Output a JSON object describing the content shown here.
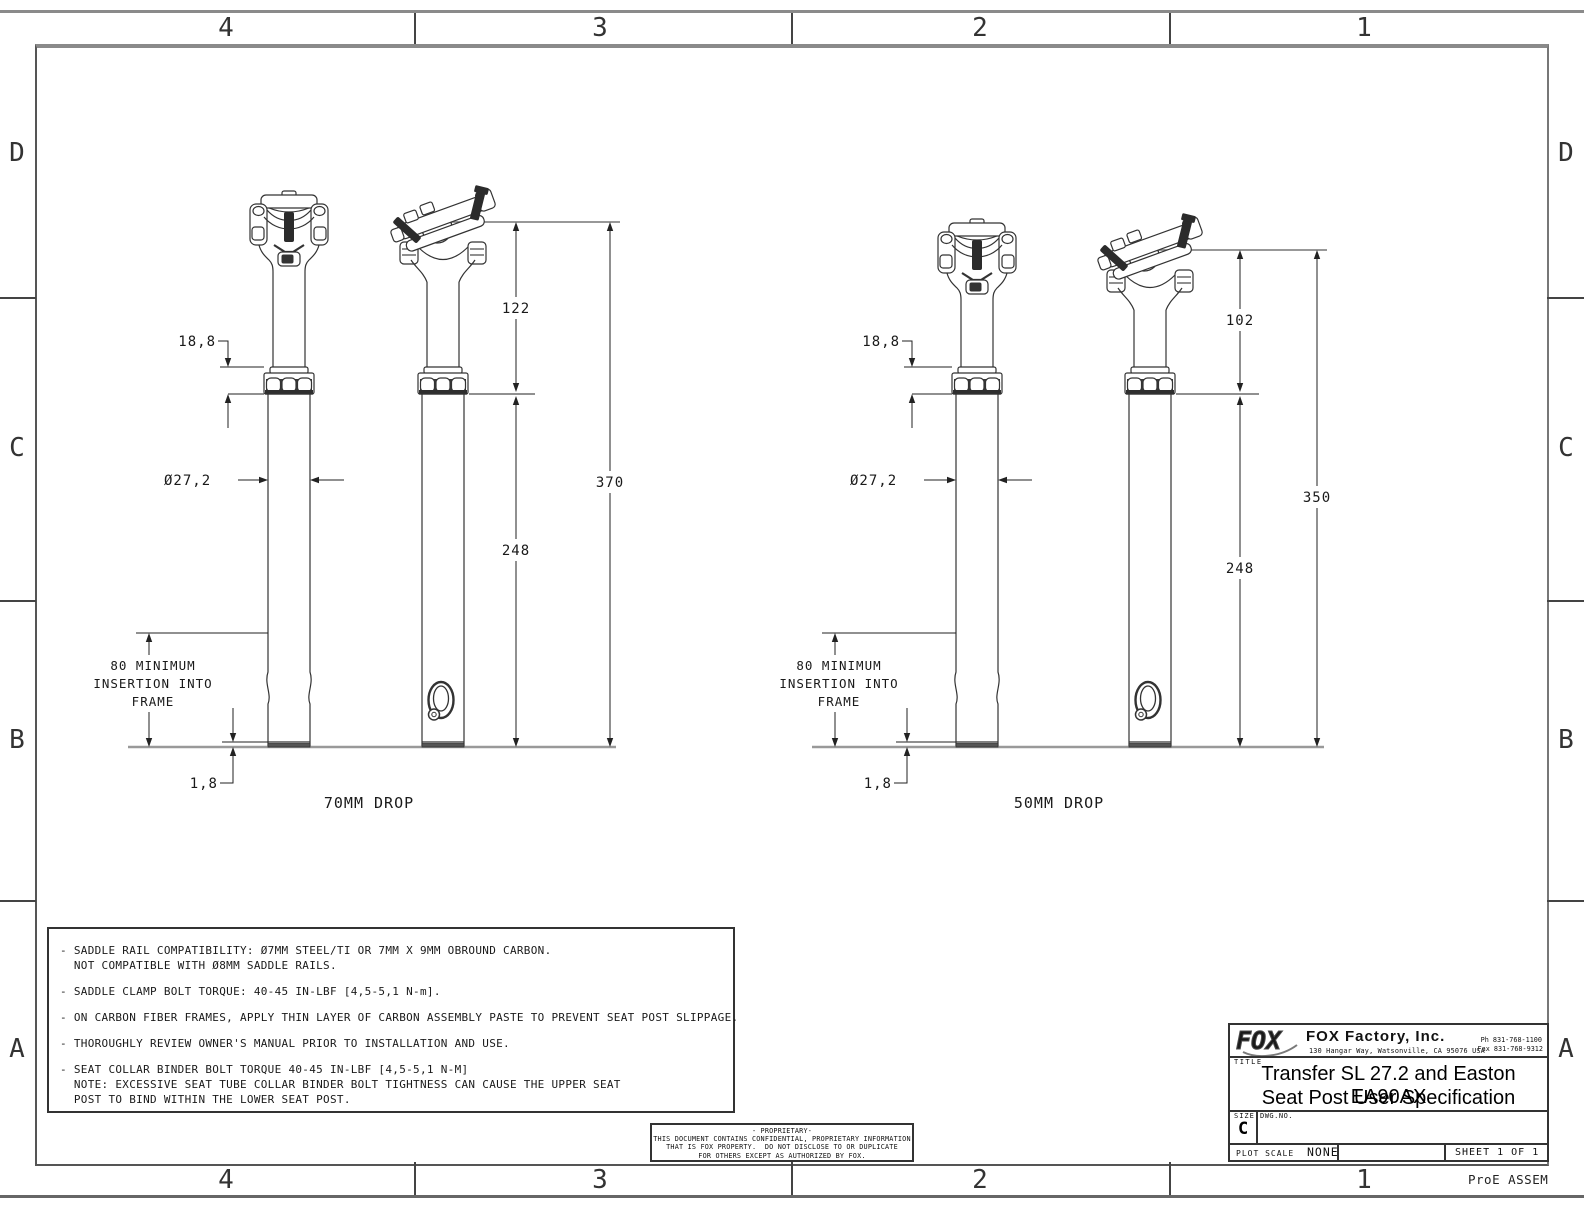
{
  "sheet": {
    "zone_columns": [
      "4",
      "3",
      "2",
      "1"
    ],
    "zone_rows": [
      "D",
      "C",
      "B",
      "A"
    ],
    "pro_e": "ProE ASSEM"
  },
  "drawings": [
    {
      "label": "70MM DROP",
      "dims": {
        "collar_stack": "18,8",
        "diameter": "Ø27,2",
        "upper_length": "122",
        "total_length": "370",
        "lower_length": "248",
        "insertion_note": [
          "80 MINIMUM",
          "INSERTION INTO",
          "FRAME"
        ],
        "base_gap": "1,8"
      }
    },
    {
      "label": "50MM DROP",
      "dims": {
        "collar_stack": "18,8",
        "diameter": "Ø27,2",
        "upper_length": "102",
        "total_length": "350",
        "lower_length": "248",
        "insertion_note": [
          "80 MINIMUM",
          "INSERTION INTO",
          "FRAME"
        ],
        "base_gap": "1,8"
      }
    }
  ],
  "notes": {
    "lines": [
      "- SADDLE RAIL COMPATIBILITY: Ø7MM STEEL/TI OR 7MM X 9MM OBROUND CARBON.",
      "  NOT COMPATIBLE WITH Ø8MM SADDLE RAILS.",
      "",
      "- SADDLE CLAMP BOLT TORQUE: 40-45 IN-LBF [4,5-5,1 N-m].",
      "",
      "- ON CARBON FIBER FRAMES, APPLY THIN LAYER OF CARBON ASSEMBLY PASTE TO PREVENT SEAT POST SLIPPAGE.",
      "",
      "- THOROUGHLY REVIEW OWNER'S MANUAL PRIOR TO INSTALLATION AND USE.",
      "",
      "- SEAT COLLAR BINDER BOLT TORQUE 40-45 IN-LBF [4,5-5,1 N-M]",
      "  NOTE: EXCESSIVE SEAT TUBE COLLAR BINDER BOLT TIGHTNESS CAN CAUSE THE UPPER SEAT",
      "  POST TO BIND WITHIN THE LOWER SEAT POST."
    ]
  },
  "proprietary": {
    "lines": [
      "- PROPRIETARY-",
      "THIS DOCUMENT CONTAINS CONFIDENTIAL, PROPRIETARY INFORMATION",
      "THAT IS FOX PROPERTY.  DO NOT DISCLOSE TO OR DUPLICATE",
      "FOR OTHERS EXCEPT AS AUTHORIZED BY FOX."
    ]
  },
  "title_block": {
    "logo_text": "FOX",
    "company": "FOX Factory, Inc.",
    "address": "130 Hangar Way, Watsonville, CA 95076 USA",
    "phone": "Ph 831-768-1100",
    "fax": "Fax 831-768-9312",
    "title_label": "TITLE",
    "title_line1": "Transfer SL 27.2 and Easton EA90AX",
    "title_line2": "Seat Post User Specification",
    "size_label": "SIZE",
    "size_value": "C",
    "dwg_label": "DWG.NO.",
    "plot_scale_label": "PLOT SCALE",
    "plot_scale_value": "NONE",
    "sheet_label": "SHEET 1 OF 1"
  }
}
